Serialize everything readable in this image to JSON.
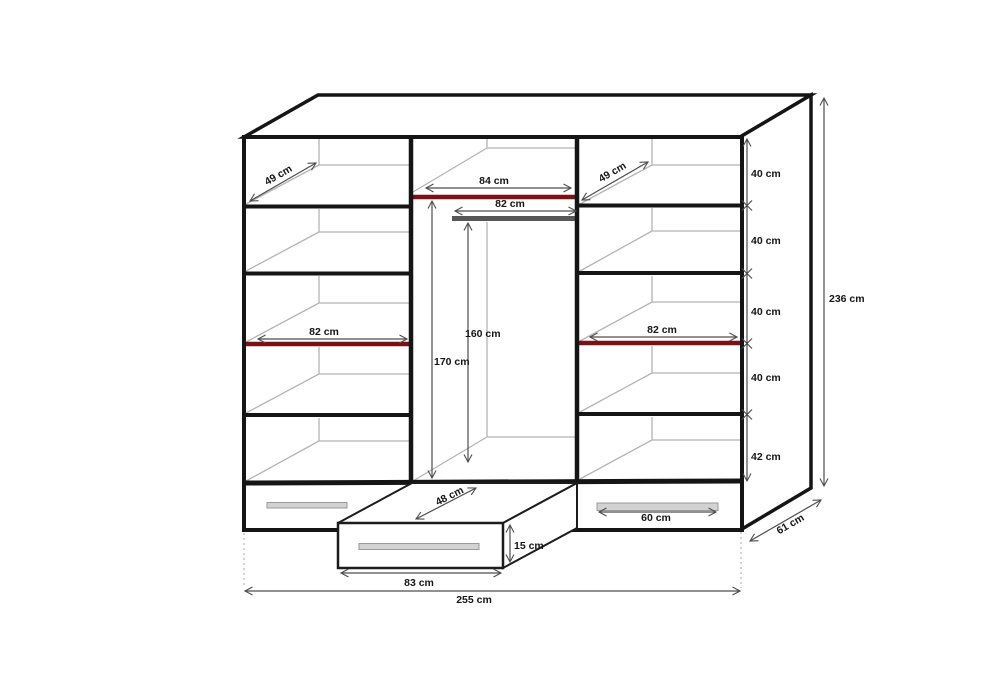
{
  "colors": {
    "frame": "#151515",
    "interior_line": "#b4b4b4",
    "shelf_highlight": "#7d1014",
    "rail": "#575757",
    "handle": "#d2d2d2",
    "dimension": "#4d4d4d",
    "label_text": "#151515",
    "background": "#ffffff"
  },
  "labels": {
    "left_shelf_depth": "49 cm",
    "right_shelf_depth": "49 cm",
    "hanging_opening_width": "84 cm",
    "hanging_rail_width": "82 cm",
    "left_shelf_width": "82 cm",
    "right_shelf_width": "82 cm",
    "hanging_height_inner": "160 cm",
    "hanging_height_full": "170 cm",
    "shelf_gap_1": "40 cm",
    "shelf_gap_2": "40 cm",
    "shelf_gap_3": "40 cm",
    "shelf_gap_4": "40 cm",
    "bottom_gap": "42 cm",
    "total_height": "236 cm",
    "total_depth": "61 cm",
    "drawer_depth": "48 cm",
    "drawer_front_height": "15 cm",
    "drawer_front_width": "83 cm",
    "drawer_handle_width": "60 cm",
    "total_width": "255 cm"
  }
}
